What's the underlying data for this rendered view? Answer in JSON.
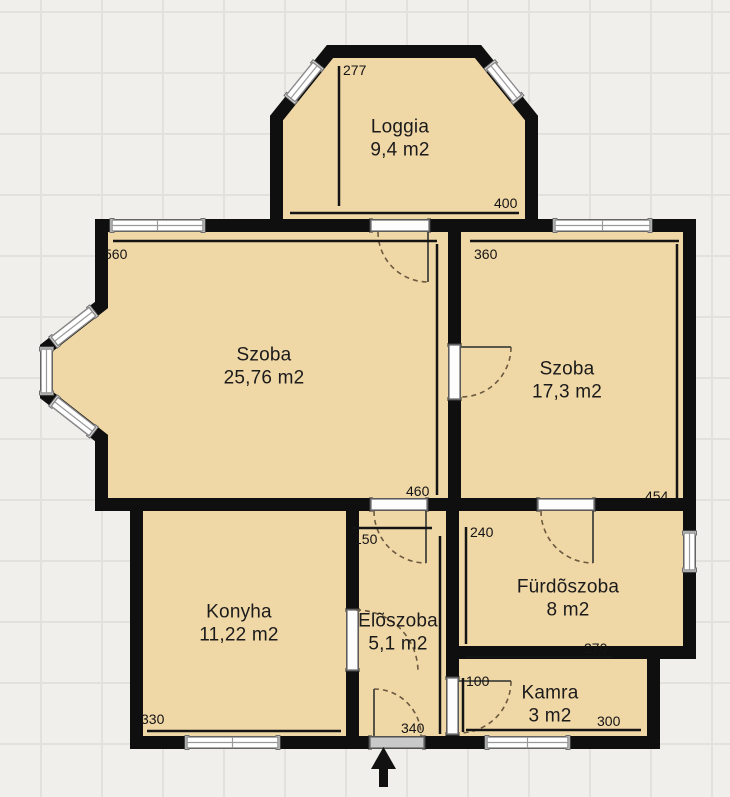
{
  "floorplan": {
    "rooms": [
      {
        "name": "Loggia",
        "area": "9,4 m2"
      },
      {
        "name": "Szoba",
        "area": "25,76 m2"
      },
      {
        "name": "Szoba",
        "area": "17,3 m2"
      },
      {
        "name": "Konyha",
        "area": "11,22 m2"
      },
      {
        "name": "Elõszoba",
        "area": "5,1 m2"
      },
      {
        "name": "Fürdõszoba",
        "area": "8 m2"
      },
      {
        "name": "Kamra",
        "area": "3 m2"
      }
    ],
    "dimensions_cm": {
      "loggia_depth": "277",
      "loggia_width": "400",
      "szoba_large_width": "560",
      "szoba_large_depth": "460",
      "szoba_small_width": "360",
      "szoba_small_depth": "454",
      "eloszoba_width": "150",
      "furdoszoba_depth": "240",
      "konyha_width": "330",
      "eloszoba_depth": "340",
      "furdoszoba_width": "270",
      "kamra_depth": "100",
      "kamra_width": "300"
    },
    "icons": {
      "entry_arrow": "up-arrow"
    },
    "colors": {
      "room_fill": "#f0d7a6",
      "wall": "#0f0f0f",
      "background": "#f1efeb",
      "grid_line": "#e3e1dc",
      "dimension_text": "#141414"
    }
  }
}
